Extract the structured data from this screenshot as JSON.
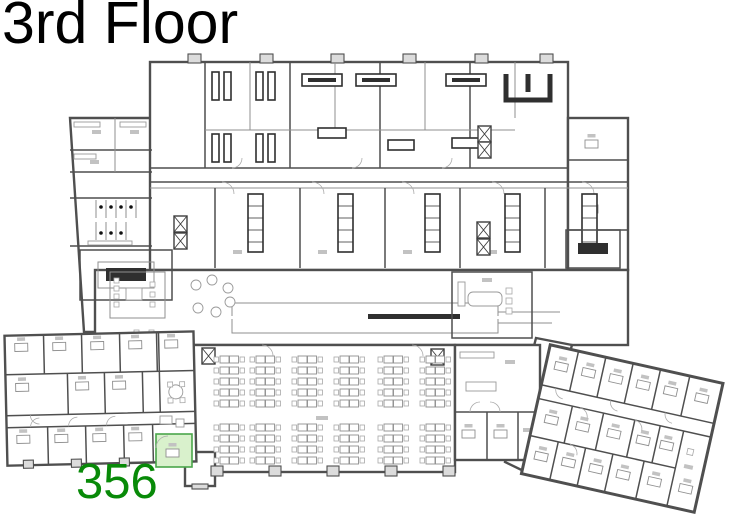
{
  "title": "3rd Floor",
  "highlighted_room": {
    "number": "356"
  },
  "colors": {
    "paper": "#ffffff",
    "title_color": "#000000",
    "room_label_color": "#088a08",
    "highlight_fill": "#d9f1cc",
    "highlight_stroke": "#4aa64a",
    "wall": "#4f4f4f",
    "wall_light": "#8f8f8f"
  }
}
